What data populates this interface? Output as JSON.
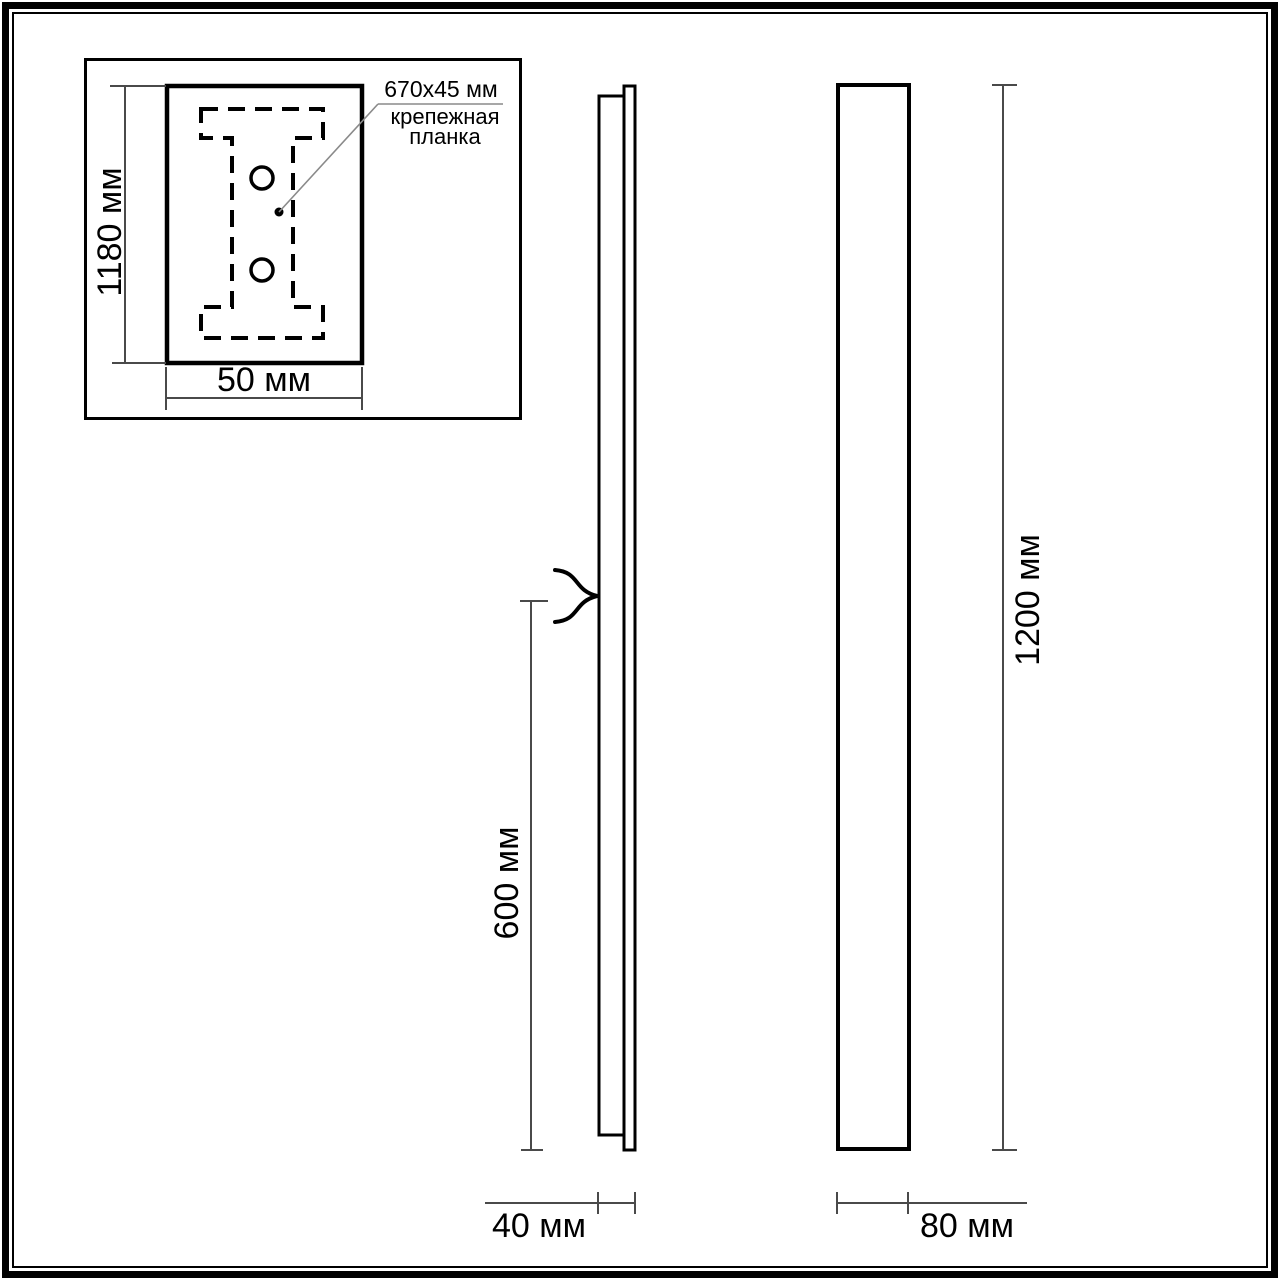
{
  "colors": {
    "ink": "#000000",
    "dimension": "#4a4a4a",
    "leader": "#8a8a8a",
    "background": "#ffffff"
  },
  "inset_view": {
    "height_label": "1180 мм",
    "width_label": "50 мм",
    "mount_plate_size": "670x45 мм",
    "mount_plate_name": "крепежная планка"
  },
  "side_view": {
    "lower_height_label": "600 мм",
    "depth_label": "40 мм"
  },
  "front_view": {
    "height_label": "1200 мм",
    "width_label": "80 мм"
  }
}
